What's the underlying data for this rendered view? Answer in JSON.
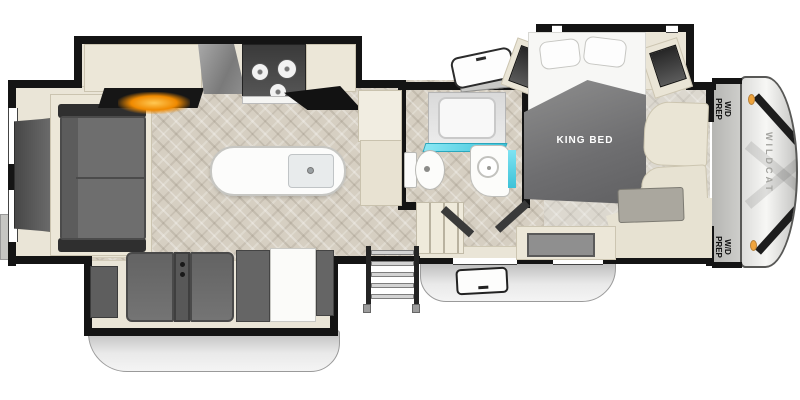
{
  "labels": {
    "king_bed": "KING BED",
    "wd_prep": "W/D PREP",
    "brand": "WILDCAT"
  },
  "colors": {
    "wall": "#141414",
    "floor_main": "#d6cfc2",
    "floor_bedroom": "#dcd8cf",
    "slide_floor": "#eae5d7",
    "cabinet_cream": "#ece7d8",
    "furniture_gray": "#6c6c6c",
    "accent_aqua": "#3dc2d8",
    "fireplace_glow": "#f08a00",
    "marker_light_orange": "#f0a43c",
    "skirt_gray": "#c9c9c9"
  },
  "fixtures": [
    "rear-tv",
    "sofa",
    "fireplace-entertainment-center",
    "range-hood",
    "cooktop-3-burner",
    "kitchen-counter",
    "refrigerator",
    "kitchen-island-with-sink",
    "theater-seating",
    "booth-dinette",
    "interior-steps",
    "entry-steps",
    "entry-door",
    "shower",
    "toilet",
    "vanity-sink",
    "king-bed",
    "nightstand-window-left",
    "nightstand-window-right",
    "front-wardrobe",
    "bedroom-dresser",
    "baggage-door",
    "front-cap",
    "marker-lights"
  ]
}
